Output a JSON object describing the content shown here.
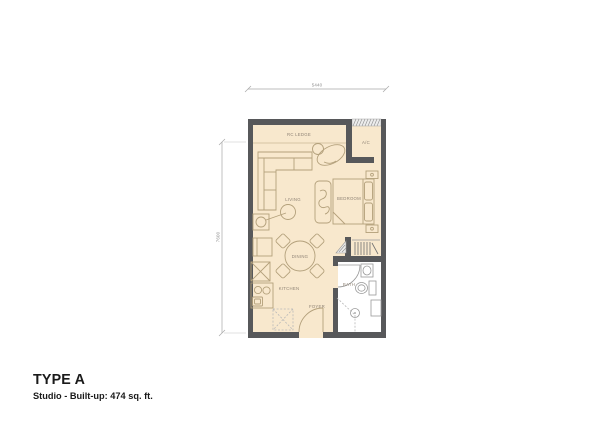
{
  "title": {
    "name": "TYPE A",
    "details": "Studio - Built-up: 474 sq. ft."
  },
  "dimensions": {
    "top": "5440",
    "left": "7600"
  },
  "rooms": {
    "rc_ledge": "RC LEDGE",
    "ac": "A/C",
    "living": "LIVING",
    "bedroom": "BEDROOM",
    "dining": "DINING",
    "kitchen": "KITCHEN",
    "foyer": "FOYER",
    "bath": "BATH"
  },
  "colors": {
    "floor": "#f8e8cd",
    "wall": "#57585a",
    "furniture_line": "#b3a07b",
    "fixture_line": "#9a9a9a",
    "bath_floor": "#ffffff",
    "dimension_line": "#a8a8a8",
    "label_text": "#8f8375",
    "title_text": "#1a1a1a"
  }
}
